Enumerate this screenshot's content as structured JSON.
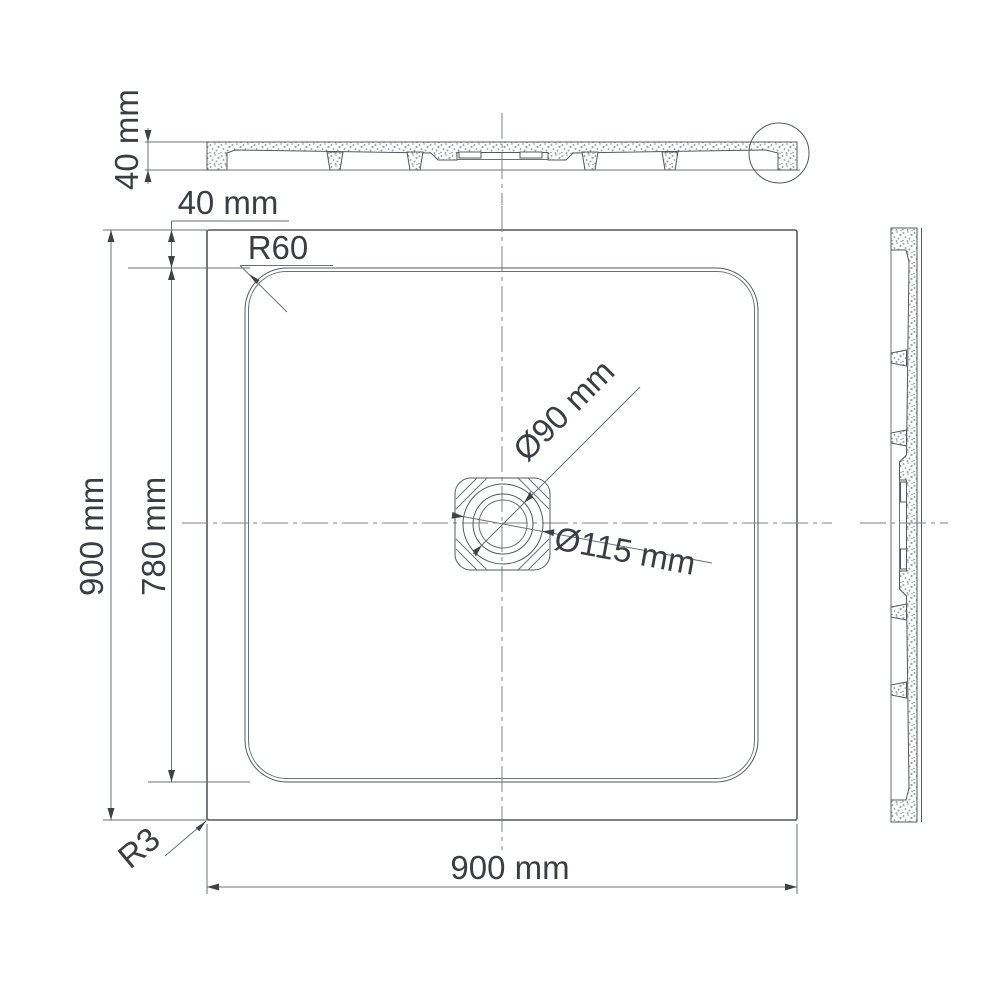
{
  "drawing": {
    "type": "technical-drawing",
    "subject": "square shower tray, three orthographic views",
    "colors": {
      "line": "#54585d",
      "text": "#3a3e42",
      "background": "#ffffff"
    },
    "labels": {
      "section_height": "40 mm",
      "top_edge_offset": "40 mm",
      "corner_radius": "R60",
      "overall_height": "900 mm",
      "inner_length": "780 mm",
      "overall_width": "900 mm",
      "base_corner_radius": "R3",
      "drain_diameter": "Ø90 mm",
      "drain_recess_diameter": "Ø115 mm"
    }
  }
}
